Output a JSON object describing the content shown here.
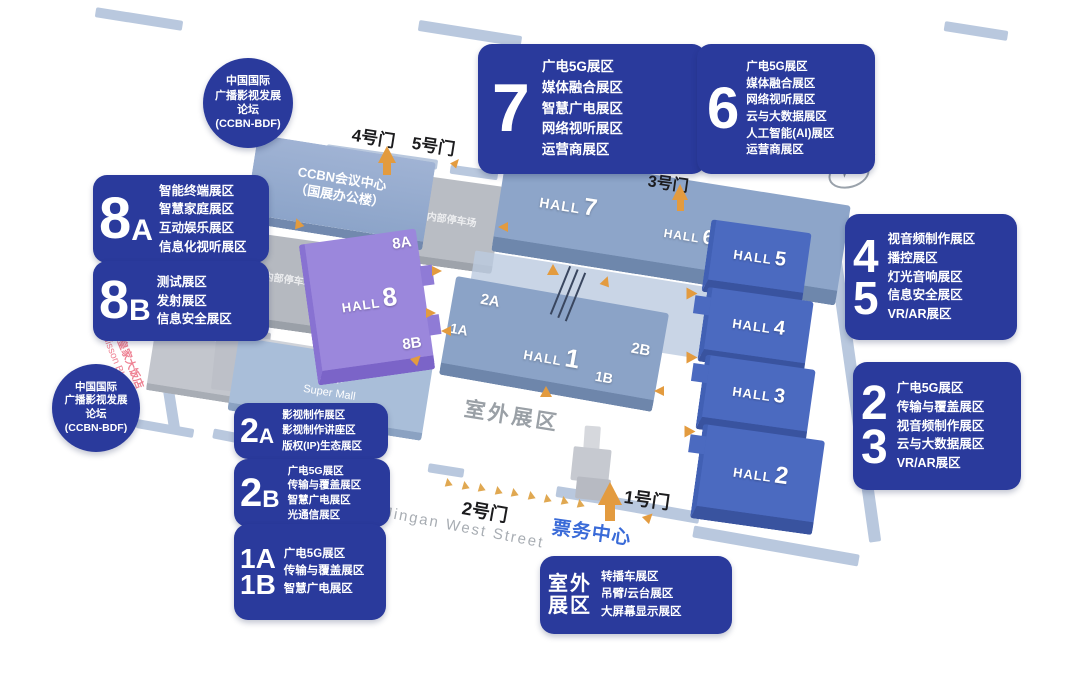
{
  "map": {
    "forum_badge": {
      "lines": [
        "中国国际",
        "广播影视发展",
        "论坛",
        "(CCBN-BDF)"
      ]
    },
    "compass": "N",
    "gates": {
      "gate1": "1号门",
      "gate2": "2号门",
      "gate3": "3号门",
      "gate4": "4号门",
      "gate5": "5号门"
    },
    "street": "(静安西街) Jingan West Street",
    "ticket_center": "票务中心",
    "outdoor_area_label": "室外展区",
    "hotel": {
      "name_zh": "北京皇家大饭店",
      "name_en": "Radisson BLU Hotel"
    },
    "buildings": {
      "conference_center": {
        "lines": [
          "CCBN会议中心",
          "（国展办公楼）"
        ]
      },
      "parking_west": "内部停车场",
      "parking_north": "内部停车场",
      "super_mall": {
        "zh": "超市",
        "en": "Super Mall"
      },
      "halls": {
        "hall8": {
          "prefix": "HALL",
          "num": "8",
          "zone_top": "8A",
          "zone_bottom": "8B"
        },
        "hall7": {
          "prefix": "HALL",
          "num": "7"
        },
        "hall6": {
          "prefix": "HALL",
          "num": "6"
        },
        "hall5": {
          "prefix": "HALL",
          "num": "5"
        },
        "hall4": {
          "prefix": "HALL",
          "num": "4"
        },
        "hall3": {
          "prefix": "HALL",
          "num": "3"
        },
        "hall2": {
          "prefix": "HALL",
          "num": "2"
        },
        "hall1": {
          "prefix": "HALL",
          "num": "1",
          "zone_nw": "2A",
          "zone_w": "1A",
          "zone_e": "2B",
          "zone_se": "1B"
        }
      }
    },
    "legend": {
      "hall7_zones": {
        "number": "7",
        "lines": [
          "广电5G展区",
          "媒体融合展区",
          "智慧广电展区",
          "网络视听展区",
          "运营商展区"
        ]
      },
      "hall6_zones": {
        "number": "6",
        "lines": [
          "广电5G展区",
          "媒体融合展区",
          "网络视听展区",
          "云与大数据展区",
          "人工智能(AI)展区",
          "运营商展区"
        ]
      },
      "hall8a_zones": {
        "number": "8",
        "letter": "A",
        "lines": [
          "智能终端展区",
          "智慧家庭展区",
          "互动娱乐展区",
          "信息化视听展区"
        ]
      },
      "hall8b_zones": {
        "number": "8",
        "letter": "B",
        "lines": [
          "测试展区",
          "发射展区",
          "信息安全展区"
        ]
      },
      "hall45_zones": {
        "numbers": [
          "4",
          "5"
        ],
        "lines": [
          "视音频制作展区",
          "播控展区",
          "灯光音响展区",
          "信息安全展区",
          "VR/AR展区"
        ]
      },
      "hall23_zones": {
        "numbers": [
          "2",
          "3"
        ],
        "lines": [
          "广电5G展区",
          "传输与覆盖展区",
          "视音频制作展区",
          "云与大数据展区",
          "VR/AR展区"
        ]
      },
      "hall2a_zones": {
        "number": "2",
        "letter": "A",
        "lines": [
          "影视制作展区",
          "影视制作讲座区",
          "版权(IP)生态展区"
        ]
      },
      "hall2b_zones": {
        "number": "2",
        "letter": "B",
        "lines": [
          "广电5G展区",
          "传输与覆盖展区",
          "智慧广电展区",
          "光通信展区"
        ]
      },
      "hall1ab_zones": {
        "numbers": [
          "1A",
          "1B"
        ],
        "lines": [
          "广电5G展区",
          "传输与覆盖展区",
          "智慧广电展区"
        ]
      },
      "outdoor_zones": {
        "title_lines": [
          "室外",
          "展区"
        ],
        "lines": [
          "转播车展区",
          "吊臂/云台展区",
          "大屏幕显示展区"
        ]
      }
    },
    "colors": {
      "legend_blue": "#2a3a9c",
      "hall_dark_blue": "#4b6ac0",
      "hall_slate_blue": "#8da5c9",
      "hall_purple": "#9b87dc",
      "arrow_orange": "#e39b3f",
      "ticket_blue": "#3a6bd8",
      "muted_gray": "#9aa0a6",
      "hotel_pink": "#ee8092"
    }
  }
}
